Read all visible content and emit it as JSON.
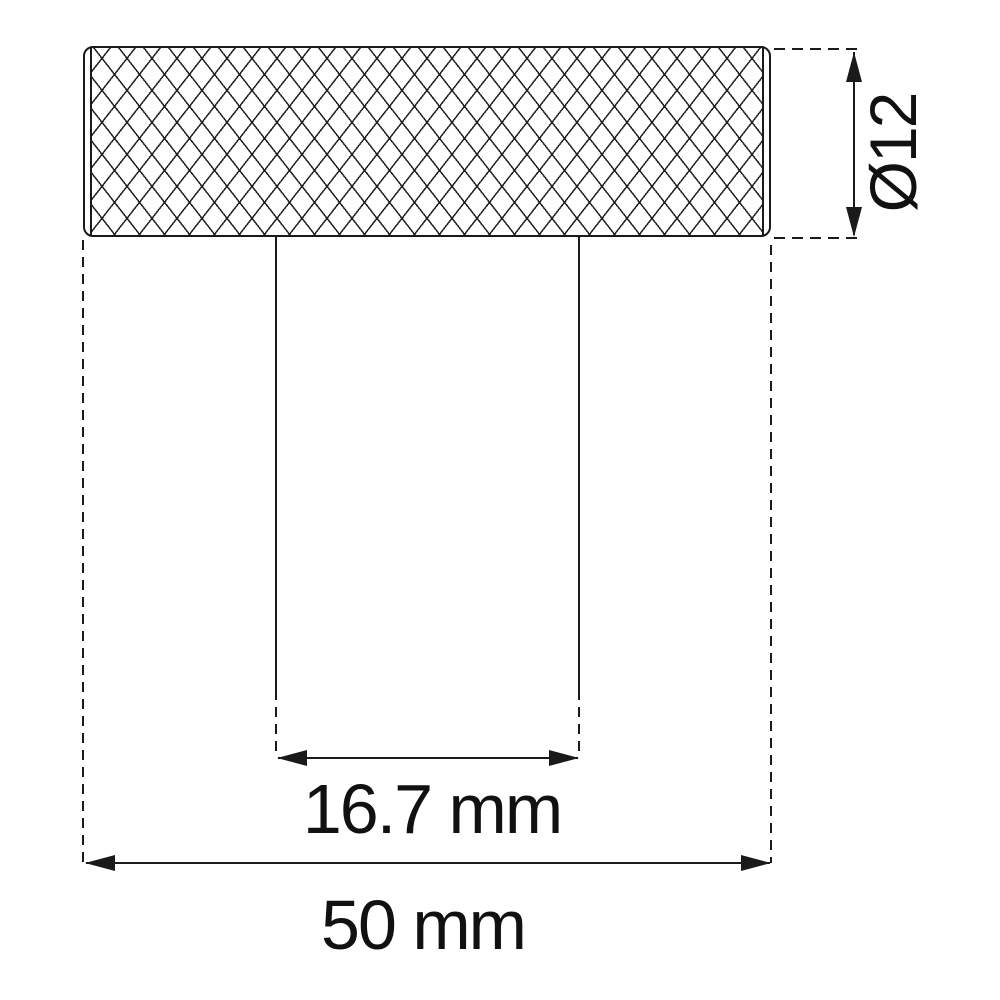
{
  "diagram": {
    "kind": "technical-drawing",
    "subject": "knurled knob with cylindrical shaft, front view",
    "line_color": "#1a1a1a",
    "background_color": "#ffffff",
    "dimensions": {
      "diameter": {
        "label": "Ø12",
        "value": 12,
        "unit": "mm",
        "orientation": "vertical",
        "measures": "knob diameter"
      },
      "shaft_width": {
        "label": "16.7 mm",
        "value": 16.7,
        "unit": "mm",
        "orientation": "horizontal",
        "measures": "shaft width"
      },
      "overall_width": {
        "label": "50 mm",
        "value": 50,
        "unit": "mm",
        "orientation": "horizontal",
        "measures": "overall knob width"
      }
    }
  }
}
